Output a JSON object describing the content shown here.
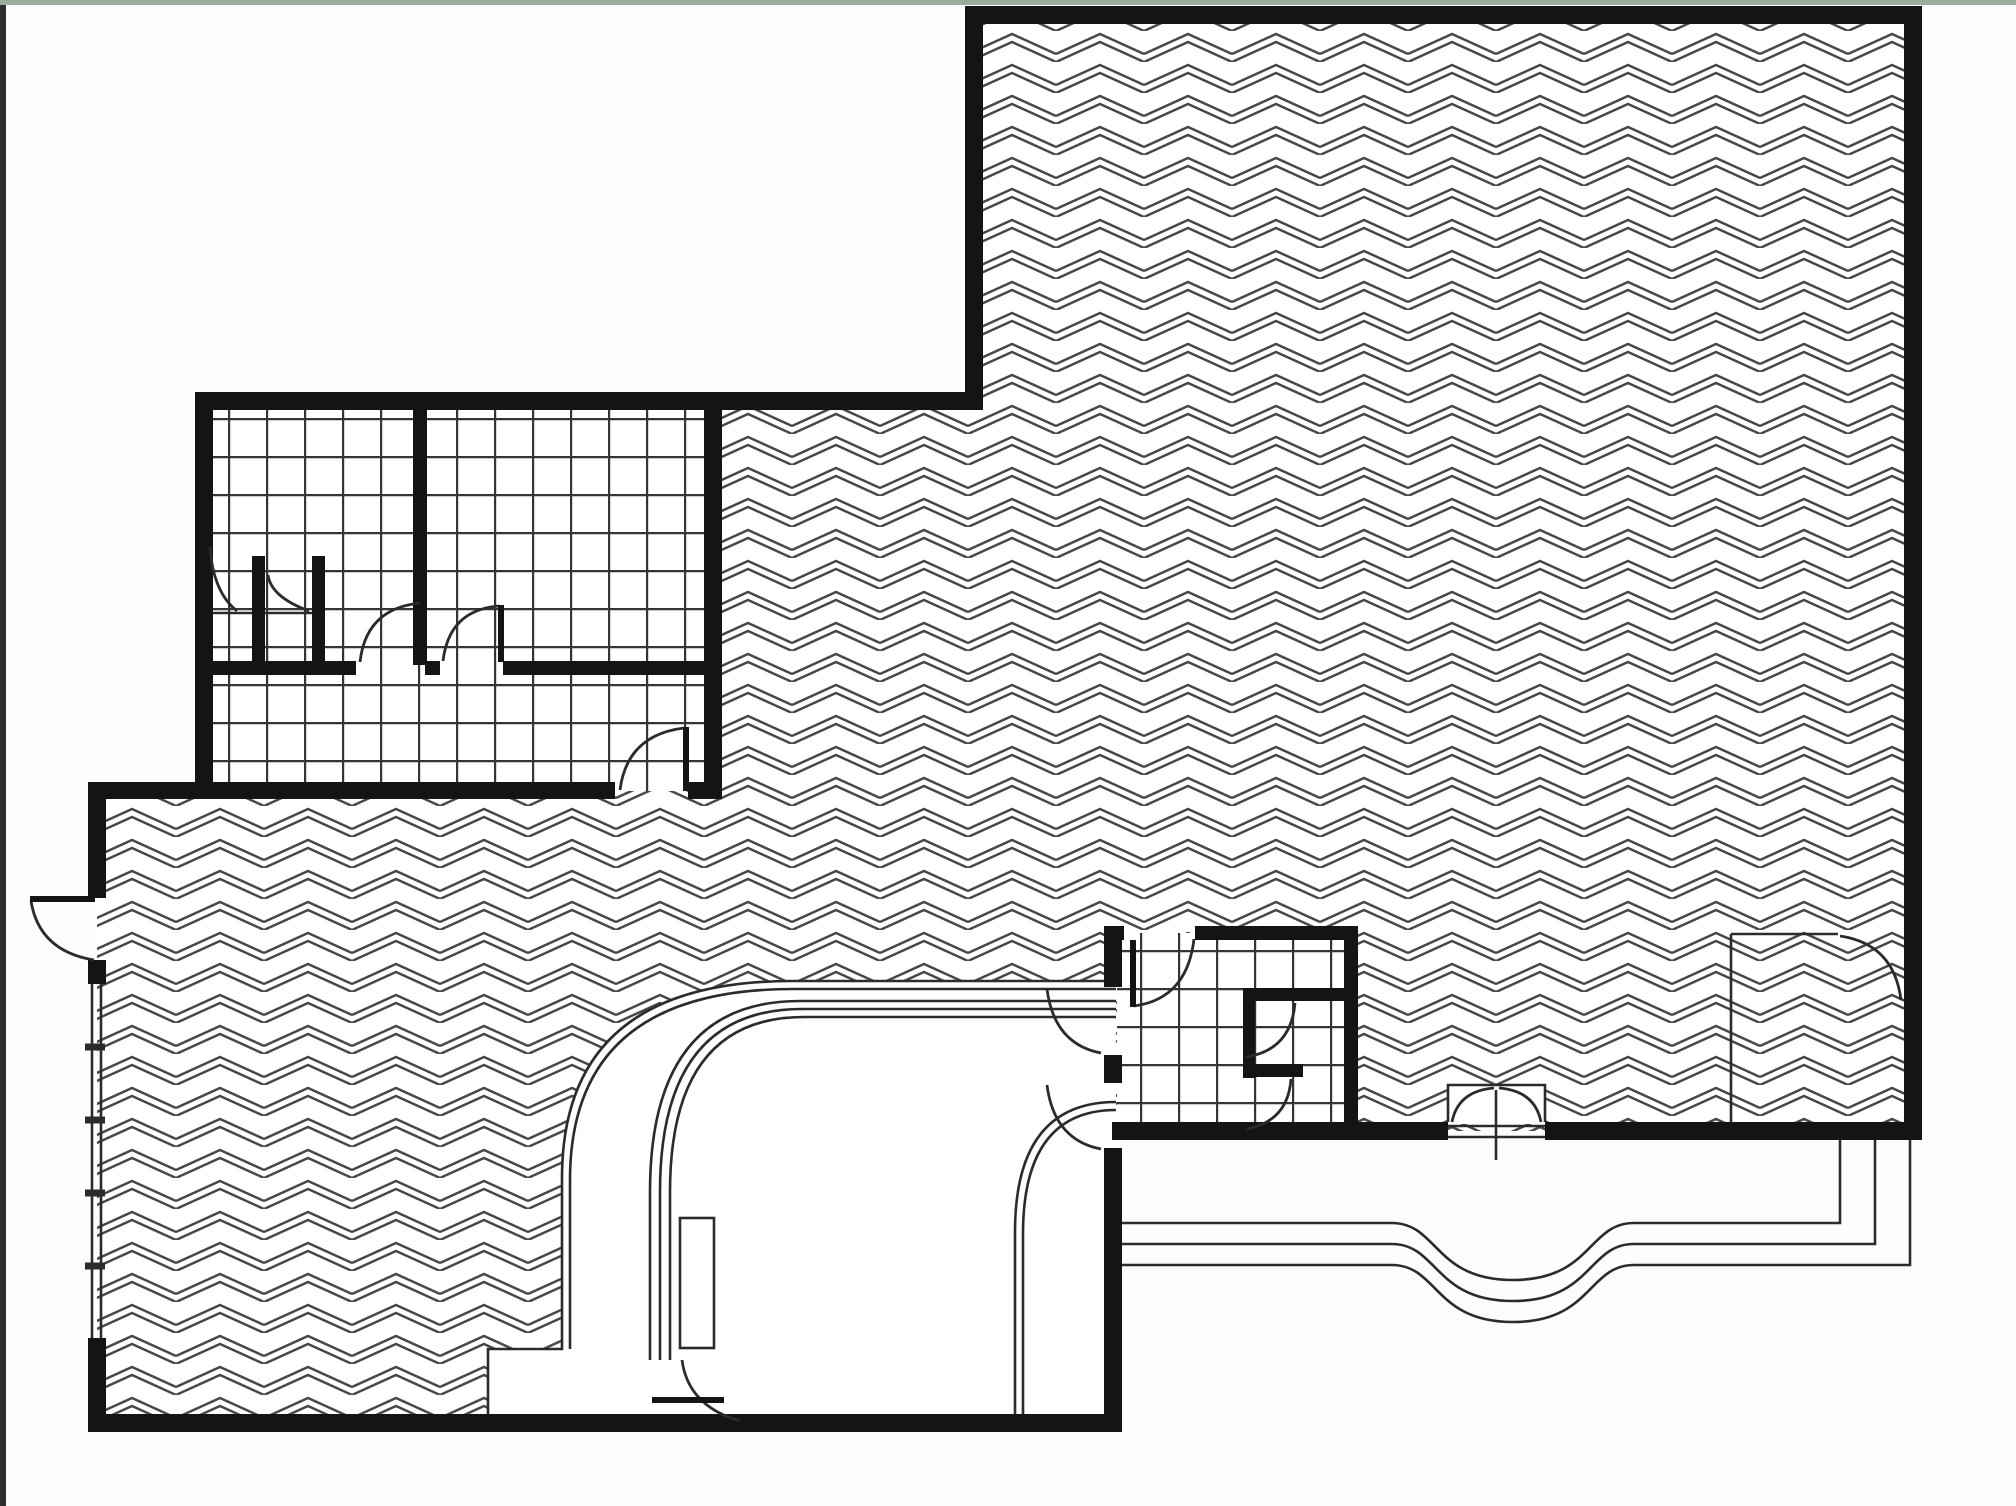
{
  "meta": {
    "drawing_kind": "architectural-floor-plan",
    "canvas": {
      "width": 2016,
      "height": 1506
    }
  },
  "colors": {
    "page_background": "#fdfdfd",
    "paper_white": "#ffffff",
    "top_edge_bar": "#9dab9d",
    "left_edge_bar": "#2e2e2e",
    "wall_fill": "#141414",
    "thin_line": "#2b2b2b",
    "chevron_hatch": "#474747",
    "tile_grid": "#353535"
  },
  "patterns": {
    "chevron": {
      "tile_w": 88,
      "tile_h": 31,
      "line1": "M0,23 L44,3 L88,23",
      "line2": "M0,31 L44,11 L88,31",
      "stroke_w": 2.4
    },
    "tile_grid": {
      "size": 38,
      "stroke_w": 2.4
    }
  },
  "artifacts": {
    "top_bar": {
      "x": 0,
      "y": 0,
      "w": 2016,
      "h": 5
    },
    "left_bar": {
      "x": 0,
      "y": 5,
      "w": 6,
      "h": 1501
    }
  },
  "building_outline_path": "M 974,15 L 1913,15 L 1913,1131 L 1113,1131 L 1113,1423 L 97,1423 L 97,791 L 204,791 L 204,401 L 974,401 Z",
  "white_regions": [
    {
      "name": "lobby-corridor-floor",
      "path": "M 488,1423 L 488,1349 L 562,1349 L 562,1178 Q 562,981 792,981 L 1116,981 L 1116,1423 Z"
    },
    {
      "name": "entry-niche",
      "path": "M 1448,1085 L 1545,1085 L 1545,1124 L 1448,1124 Z"
    }
  ],
  "tile_regions": [
    {
      "name": "restrooms-north-west",
      "x": 204,
      "y": 401,
      "w": 501,
      "h": 390
    },
    {
      "name": "restroom-south-east",
      "x": 1117,
      "y": 933,
      "w": 227,
      "h": 190
    }
  ],
  "walls": [
    {
      "name": "wall-top",
      "x": 965,
      "y": 6,
      "w": 957,
      "h": 18
    },
    {
      "name": "wall-right",
      "x": 1904,
      "y": 6,
      "w": 18,
      "h": 1134
    },
    {
      "name": "wall-bottom-right-a",
      "x": 1112,
      "y": 1122,
      "w": 336,
      "h": 18
    },
    {
      "name": "wall-bottom-right-b",
      "x": 1545,
      "y": 1122,
      "w": 377,
      "h": 18
    },
    {
      "name": "wall-main-left",
      "x": 965,
      "y": 6,
      "w": 18,
      "h": 404
    },
    {
      "name": "wall-restrooms-top",
      "x": 195,
      "y": 392,
      "w": 788,
      "h": 18
    },
    {
      "name": "wall-restrooms-left",
      "x": 195,
      "y": 392,
      "w": 18,
      "h": 407
    },
    {
      "name": "wall-west-horiz-a",
      "x": 88,
      "y": 782,
      "w": 527,
      "h": 17
    },
    {
      "name": "wall-west-horiz-b",
      "x": 688,
      "y": 782,
      "w": 34,
      "h": 17
    },
    {
      "name": "wall-left-ext-upper",
      "x": 88,
      "y": 782,
      "w": 18,
      "h": 116
    },
    {
      "name": "wall-left-ext-mid",
      "x": 88,
      "y": 960,
      "w": 18,
      "h": 24
    },
    {
      "name": "wall-left-ext-lower",
      "x": 88,
      "y": 1338,
      "w": 18,
      "h": 94
    },
    {
      "name": "wall-bottom",
      "x": 88,
      "y": 1414,
      "w": 1034,
      "h": 18
    },
    {
      "name": "wall-lobby-right-lower",
      "x": 1104,
      "y": 1148,
      "w": 18,
      "h": 284
    },
    {
      "name": "wall-restrooms-right",
      "x": 704,
      "y": 401,
      "w": 18,
      "h": 390
    },
    {
      "name": "wall-restroom-mid-a",
      "x": 204,
      "y": 661,
      "w": 152,
      "h": 14
    },
    {
      "name": "wall-restroom-mid-b",
      "x": 425,
      "y": 661,
      "w": 15,
      "h": 14
    },
    {
      "name": "wall-restroom-mid-c",
      "x": 503,
      "y": 661,
      "w": 201,
      "h": 14
    },
    {
      "name": "wall-restroom-divider",
      "x": 413,
      "y": 401,
      "w": 14,
      "h": 264
    },
    {
      "name": "stall-partition-1",
      "x": 252,
      "y": 556,
      "w": 13,
      "h": 107
    },
    {
      "name": "stall-partition-2",
      "x": 312,
      "y": 556,
      "w": 13,
      "h": 107
    },
    {
      "name": "wall-se-room-top-a",
      "x": 1104,
      "y": 926,
      "w": 20,
      "h": 14
    },
    {
      "name": "wall-se-room-top-b",
      "x": 1195,
      "y": 926,
      "w": 163,
      "h": 14
    },
    {
      "name": "wall-lobby-right-a",
      "x": 1104,
      "y": 926,
      "w": 18,
      "h": 61
    },
    {
      "name": "wall-lobby-right-b",
      "x": 1104,
      "y": 1055,
      "w": 18,
      "h": 28
    },
    {
      "name": "wall-se-room-right",
      "x": 1344,
      "y": 926,
      "w": 14,
      "h": 197
    },
    {
      "name": "wall-stall-e-vertical",
      "x": 1243,
      "y": 988,
      "w": 12,
      "h": 90
    },
    {
      "name": "wall-stall-e-top",
      "x": 1243,
      "y": 988,
      "w": 107,
      "h": 13
    },
    {
      "name": "wall-stall-e-bottom",
      "x": 1243,
      "y": 1064,
      "w": 60,
      "h": 13
    }
  ],
  "thin_lines": [
    {
      "name": "lobby-outer-edge-1",
      "d": "M 488,1423 L 488,1349 L 562,1349 L 562,1178 Q 562,981 792,981 L 1116,981"
    },
    {
      "name": "lobby-outer-edge-2",
      "d": "M 570,1349 L 570,1180 Q 570,989 793,989 L 1116,989"
    },
    {
      "name": "curved-rail-1",
      "d": "M 650,1360 L 650,1192 Q 650,1001 800,1001 L 1116,1001"
    },
    {
      "name": "curved-rail-2",
      "d": "M 660,1360 L 660,1192 Q 660,1009 802,1009 L 1116,1009"
    },
    {
      "name": "curved-rail-3",
      "d": "M 670,1360 L 670,1192 Q 670,1017 804,1017 L 1116,1017"
    },
    {
      "name": "lobby-inner-edge-1",
      "d": "M 1015,1423 L 1015,1232 Q 1015,1102 1116,1102"
    },
    {
      "name": "lobby-inner-edge-2",
      "d": "M 1023,1423 L 1023,1234 Q 1023,1110 1116,1110"
    },
    {
      "name": "step-line-1",
      "d": "M 1122,1223 L 1392,1223 C 1438,1223 1434,1280 1513,1280 C 1592,1280 1588,1223 1634,1223 L 1840,1223 L 1840,1140"
    },
    {
      "name": "step-line-2",
      "d": "M 1122,1244 L 1392,1244 C 1438,1244 1434,1301 1513,1301 C 1592,1301 1588,1244 1634,1244 L 1875,1244 L 1875,1140"
    },
    {
      "name": "step-line-3",
      "d": "M 1122,1265 L 1392,1265 C 1438,1265 1434,1322 1513,1322 C 1592,1322 1588,1265 1634,1265 L 1910,1265 L 1910,1140"
    },
    {
      "name": "storefront-glazing-1",
      "d": "M 92,982 L 92,1338"
    },
    {
      "name": "storefront-glazing-2",
      "d": "M 101,982 L 101,1338"
    },
    {
      "name": "niche-outline",
      "d": "M 1448,1122 L 1448,1085 L 1545,1085 L 1545,1122"
    },
    {
      "name": "niche-sill-1",
      "d": "M 1448,1126 L 1545,1126"
    },
    {
      "name": "niche-sill-2",
      "d": "M 1448,1137 L 1545,1137"
    },
    {
      "name": "niche-center-post",
      "d": "M 1496,1090 L 1496,1160"
    },
    {
      "name": "store-room-wall-left",
      "d": "M 1731,1140 L 1731,934"
    },
    {
      "name": "store-room-wall-top",
      "d": "M 1731,934 L 1838,934"
    },
    {
      "name": "stall-front-rail",
      "d": "M 206,613 L 314,613"
    }
  ],
  "mullion_ticks": [
    {
      "name": "mullion-tick",
      "d": "M 85,1047 L 105,1047"
    },
    {
      "name": "mullion-tick",
      "d": "M 85,1120 L 105,1120"
    },
    {
      "name": "mullion-tick",
      "d": "M 85,1193 L 105,1193"
    },
    {
      "name": "mullion-tick",
      "d": "M 85,1266 L 105,1266"
    }
  ],
  "door_leaves": [
    {
      "name": "door-leaf-exterior-west",
      "d": "M 30,899 L 95,899"
    },
    {
      "name": "door-leaf-corridor",
      "d": "M 686,727 L 686,791"
    },
    {
      "name": "door-leaf-restroom-a",
      "d": "M 423,602 L 423,662"
    },
    {
      "name": "door-leaf-restroom-b",
      "d": "M 501,605 L 501,662"
    },
    {
      "name": "door-leaf-se-room",
      "d": "M 1133,940 L 1133,1007"
    },
    {
      "name": "door-leaf-band-end",
      "d": "M 652,1400 L 724,1400"
    }
  ],
  "door_arcs": [
    {
      "name": "door-arc-exterior-west",
      "d": "M 31,901 Q 39,951 94,960"
    },
    {
      "name": "door-arc-corridor",
      "d": "M 620,790 Q 627,735 684,728"
    },
    {
      "name": "door-arc-restroom-a",
      "d": "M 360,662 Q 366,608 421,603"
    },
    {
      "name": "door-arc-restroom-b",
      "d": "M 443,661 Q 449,610 499,606"
    },
    {
      "name": "door-arc-stall-1",
      "d": "M 210,547 Q 213,592 237,611"
    },
    {
      "name": "door-arc-stall-2",
      "d": "M 268,575 Q 271,597 309,611"
    },
    {
      "name": "door-arc-se-room",
      "d": "M 1194,939 Q 1187,999 1134,1006"
    },
    {
      "name": "door-arc-e-stall-1",
      "d": "M 1295,1003 Q 1291,1050 1246,1057"
    },
    {
      "name": "door-arc-e-stall-2",
      "d": "M 1291,1079 Q 1288,1121 1247,1129"
    },
    {
      "name": "door-arc-lobby-1",
      "d": "M 1047,989 Q 1054,1044 1101,1053"
    },
    {
      "name": "door-arc-lobby-2",
      "d": "M 1047,1085 Q 1054,1140 1101,1149"
    },
    {
      "name": "door-arc-band-end",
      "d": "M 682,1360 Q 688,1406 740,1421"
    },
    {
      "name": "door-arc-store-room",
      "d": "M 1840,936 Q 1894,944 1901,1000"
    },
    {
      "name": "door-arc-niche-left",
      "d": "M 1452,1122 Q 1458,1091 1494,1088"
    },
    {
      "name": "door-arc-niche-right",
      "d": "M 1541,1122 Q 1535,1091 1499,1088"
    }
  ],
  "leaf_outline_rects": [
    {
      "name": "door-leaf-band-open",
      "x": 680,
      "y": 1218,
      "w": 34,
      "h": 130
    }
  ]
}
